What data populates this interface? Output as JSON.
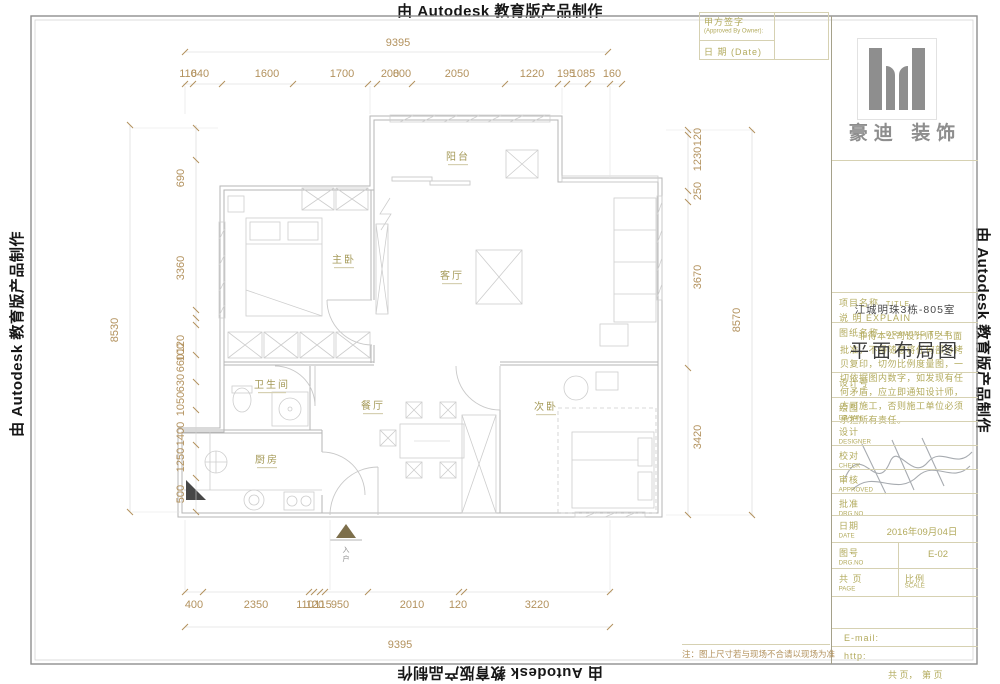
{
  "watermark": {
    "text": "由 Autodesk 教育版产品制作"
  },
  "sign_table": {
    "owner_label": "甲方签字",
    "owner_en": "(Approved By Owner):",
    "date_label": "日 期 (Date)"
  },
  "brand": {
    "name": "豪迪 装饰"
  },
  "explain": {
    "label": "说 明 EXPLAIN",
    "text": "非得本公司设计师之书面批准，不得随意将任何部分拷贝复印，切勿比例度量图，一切依据图内数字，如发现有任何矛盾，应立即通知设计师，方可施工，否则施工单位必须承担所有责任。"
  },
  "project": {
    "label": "项目名称",
    "label_en": "TITLE",
    "name": "江城明珠3栋-805室"
  },
  "drawing": {
    "label": "图纸名称",
    "label_en": "DRAWING  TELE",
    "name": "平面布局图"
  },
  "fields": {
    "design_no": "设计号",
    "drawn": "绘图",
    "drawn_en": "DRAWN",
    "designer": "设计",
    "designer_en": "DESIGNER",
    "check": "校对",
    "check_en": "CHECK",
    "approved": "审核",
    "approved_en": "APPROVED",
    "ratify": "批准",
    "ratify_en": "DRG NO",
    "date": "日期",
    "date_en": "DATE",
    "date_value": "2016年09月04日",
    "drg": "图号",
    "drg_en": "DRG.NO",
    "drg_value": "E-02",
    "page": "共 页",
    "page_en": "PAGE",
    "scale": "比例",
    "scale_en": "SCALE",
    "email": "E-mail:",
    "http": "http:"
  },
  "footer": {
    "pages": "共 页，　第 页",
    "note": "注：图上尺寸若与现场不合请以现场为准"
  },
  "rooms": {
    "balcony": "阳台",
    "master": "主卧",
    "living": "客厅",
    "bath": "卫生间",
    "dining": "餐厅",
    "second": "次卧",
    "kitchen": "厨房",
    "entry": "入户"
  },
  "dims": {
    "top_total": "9395",
    "top": [
      "110",
      "640",
      "1600",
      "1700",
      "200",
      "800",
      "2050",
      "1220",
      "195",
      "1085",
      "160"
    ],
    "bottom": [
      "400",
      "2350",
      "110",
      "120",
      "115",
      "950",
      "2010",
      "120",
      "3220"
    ],
    "bottom_total": "9395",
    "left_total": "8530",
    "left": [
      "690",
      "3360",
      "120",
      "100",
      "660",
      "630",
      "1050",
      "1400",
      "1250",
      "500"
    ],
    "right": [
      "120",
      "1230",
      "250",
      "3670",
      "3420"
    ],
    "right_total": "8570"
  },
  "colors": {
    "dim_text": "#b3925e",
    "room_text": "#a59a58",
    "titleblock_text": "#b3ab5e",
    "plan_line": "#bcbcbc",
    "grid_line": "#d6d1b2",
    "watermark": "#161616"
  }
}
